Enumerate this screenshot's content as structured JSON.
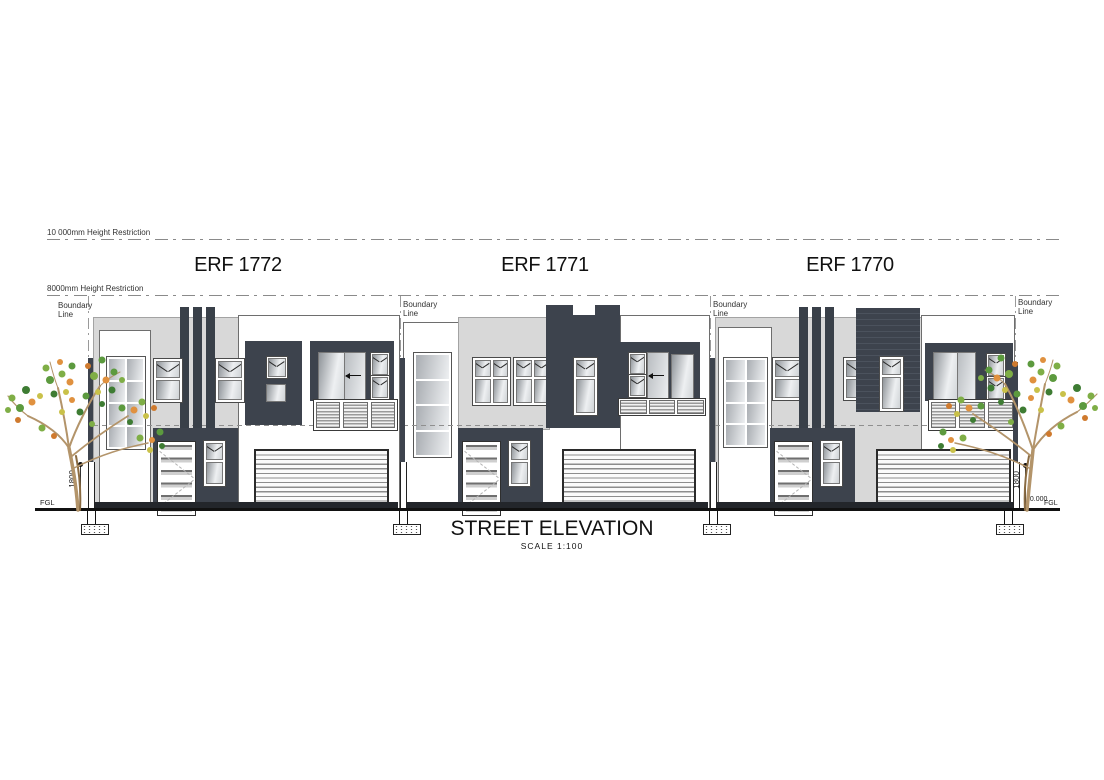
{
  "labels": {
    "hr10000": "10 000mm  Height  Restriction",
    "hr8000": "8000mm  Height  Restriction",
    "boundary_line1": "Boundary",
    "boundary_line2": "Line",
    "fgl": "FGL",
    "level_right": "10.000",
    "dim_1800": "1800"
  },
  "erfs": [
    {
      "label": "ERF 1772"
    },
    {
      "label": "ERF 1771"
    },
    {
      "label": "ERF 1770"
    }
  ],
  "title": {
    "main": "STREET ELEVATION",
    "scale": "SCALE  1:100"
  },
  "colors": {
    "charcoal": "#3d434d",
    "facade_gray": "#d8d8d8",
    "white": "#ffffff",
    "ground": "#23262b",
    "leaf_green": "#5c9a3e",
    "leaf_olive": "#97a83f",
    "leaf_orange": "#e0913f",
    "branch": "#b3946a"
  }
}
